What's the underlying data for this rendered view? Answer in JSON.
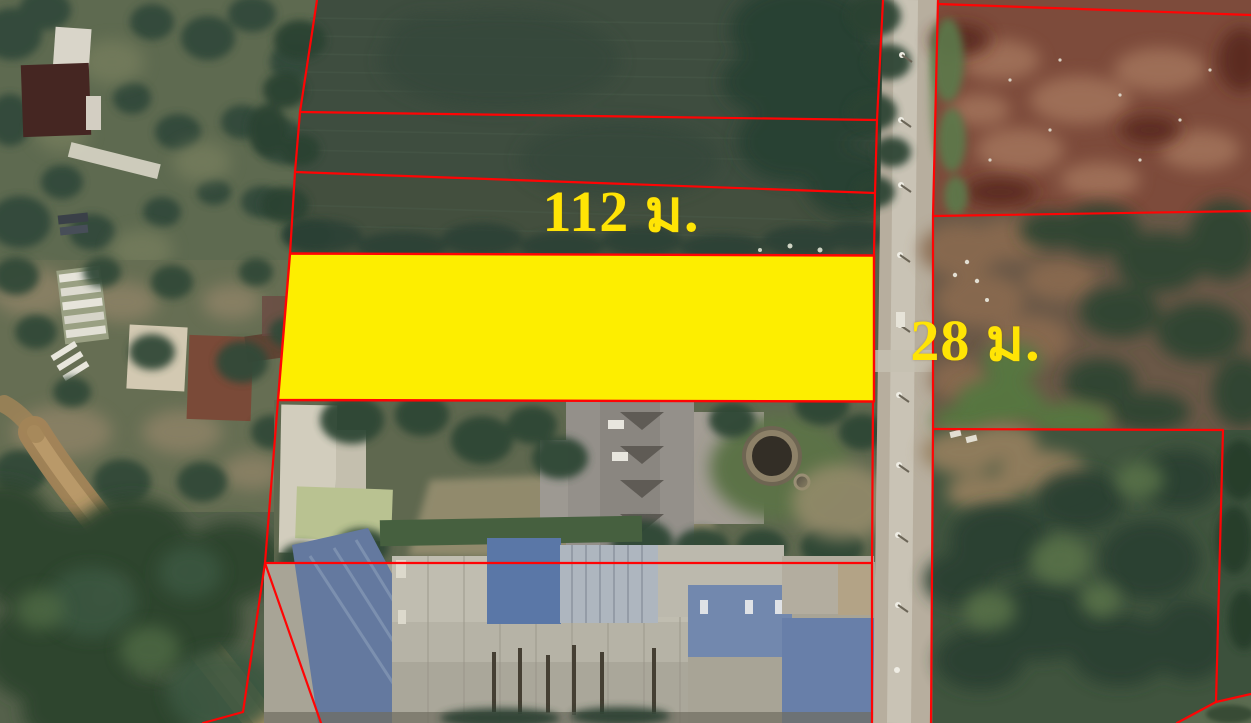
{
  "map": {
    "view": "satellite",
    "labels": {
      "width_label": "112 ม.",
      "depth_label": "28 ม."
    },
    "plot": {
      "width_m": 112,
      "depth_m": 28,
      "highlight_color": "#FDEE00",
      "boundary_color": "#FF0404",
      "label_color": "#FFE405"
    }
  }
}
